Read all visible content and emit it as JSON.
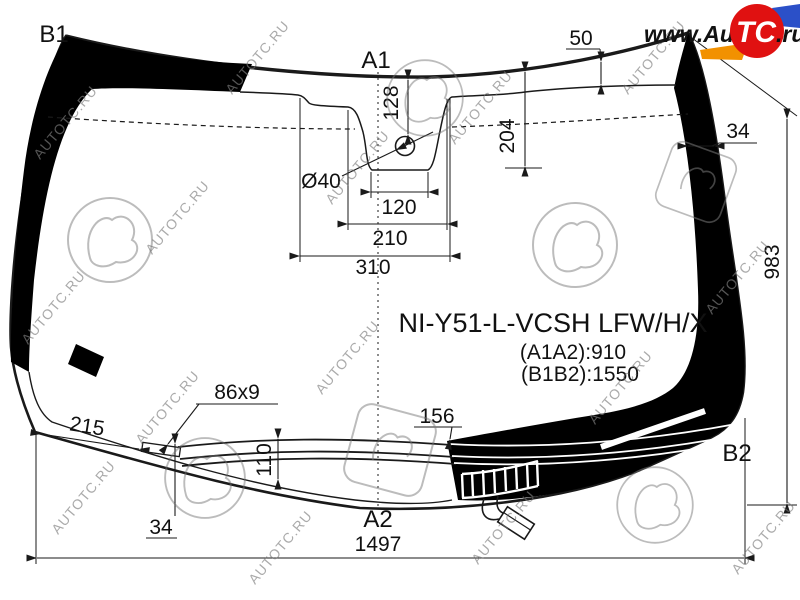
{
  "labels": {
    "b1": "B1",
    "a1": "A1",
    "a2": "A2",
    "b2": "B2"
  },
  "part": {
    "code": "NI-Y51-L-VCSH LFW/H/X",
    "a1a2": "(A1A2):910",
    "b1b2": "(B1B2):1550"
  },
  "dims": {
    "top_band": "50",
    "right_band": "34",
    "height": "983",
    "hole": "Ø40",
    "hole_depth": "128",
    "bracket_depth": "204",
    "notch_width": "120",
    "bracket_width": "210",
    "bracket_outer": "310",
    "molding": "86x9",
    "left_offset": "215",
    "deicer_height": "110",
    "left_band": "34",
    "deicer_top": "156",
    "width": "1497"
  },
  "watermark": {
    "text": "AUTOTC.RU"
  },
  "logo": {
    "www": "www.Auto",
    "tc": "TC",
    "ru": ".ru"
  },
  "colors": {
    "accent_red": "#e01111",
    "accent_orange": "#f29100",
    "accent_blue": "#2b50c8",
    "line": "#1a1a1a"
  }
}
